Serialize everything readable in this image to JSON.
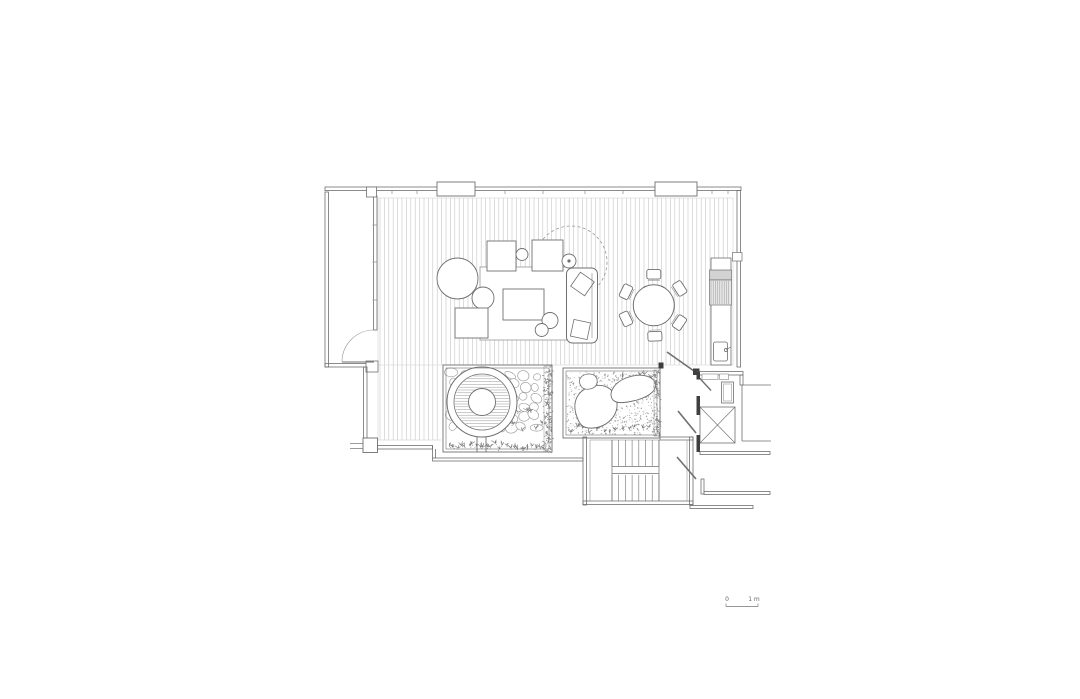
{
  "meta": {
    "background": "#ffffff"
  },
  "colors": {
    "ink": "#6f6f6f",
    "dark": "#3f3f3f",
    "mid": "#979797",
    "light": "#c6c6c6",
    "faint": "#d9d9d9",
    "green": "#7b7b7b",
    "fillGray": "#d2d2d2",
    "fillLight": "#e7e7e7",
    "white": "#ffffff",
    "text": "#666666"
  },
  "scale_bar": {
    "zero": "0",
    "one": "1 m"
  },
  "geometry": [
    {
      "k": "vlines",
      "n": "deck-boards-main",
      "x1": 380,
      "x2": 731,
      "step": 4.4,
      "y1": 198,
      "y2": 365,
      "s": "light",
      "sw": 0.6
    },
    {
      "k": "vlines",
      "n": "deck-boards-lower",
      "x1": 380,
      "x2": 440,
      "step": 4.4,
      "y1": 365,
      "y2": 440,
      "s": "light",
      "sw": 0.6
    },
    {
      "k": "rect",
      "n": "deck-edge",
      "x": 378,
      "y": 198,
      "w": 355,
      "h": 167,
      "s": "faint",
      "sw": 0.7
    },
    {
      "k": "line",
      "n": "deck-lower-edge-bottom",
      "x1": 378,
      "y1": 440,
      "x2": 441,
      "y2": 440,
      "s": "faint",
      "sw": 0.7
    },
    {
      "k": "line",
      "n": "deck-lower-edge-left",
      "x1": 378,
      "y1": 365,
      "x2": 378,
      "y2": 440,
      "s": "faint",
      "sw": 0.7
    },
    {
      "k": "pebbles",
      "n": "pebble-paving",
      "x": 448,
      "y": 370,
      "w": 94,
      "h": 66,
      "seed": 7
    },
    {
      "k": "plants",
      "n": "garden-ferns",
      "x": 505,
      "y": 398,
      "w": 38,
      "h": 38,
      "cnt": 8,
      "seed": 5
    },
    {
      "k": "circle",
      "n": "hot-tub-outer",
      "cx": 482,
      "cy": 402,
      "r": 35,
      "f": "white",
      "s": "ink",
      "sw": 1
    },
    {
      "k": "circle",
      "n": "hot-tub-rim",
      "cx": 482,
      "cy": 402,
      "r": 28,
      "s": "ink",
      "sw": 0.8
    },
    {
      "k": "hlines",
      "n": "hot-tub-water",
      "x1": 453,
      "x2": 511,
      "y1": 376,
      "y2": 429,
      "step": 2.8,
      "s": "mid",
      "sw": 0.5,
      "clip": [
        482,
        402,
        27.2
      ]
    },
    {
      "k": "circle",
      "n": "hot-tub-seat",
      "cx": 482,
      "cy": 402,
      "r": 13.5,
      "f": "white",
      "s": "ink",
      "sw": 0.9
    },
    {
      "k": "line",
      "n": "screen-post-1",
      "x1": 477,
      "y1": 437,
      "x2": 477,
      "y2": 452,
      "s": "ink",
      "sw": 0.9
    },
    {
      "k": "line",
      "n": "screen-post-2",
      "x1": 486,
      "y1": 437,
      "x2": 486,
      "y2": 452,
      "s": "ink",
      "sw": 0.9
    },
    {
      "k": "plants",
      "n": "planting-strip",
      "x": 447,
      "y": 441,
      "w": 98,
      "h": 10,
      "cnt": 26,
      "seed": 11
    },
    {
      "k": "hedge",
      "n": "hedge-strip-left-garden",
      "x": 544,
      "y": 366,
      "w": 8,
      "h": 86,
      "cnt": 170,
      "seed": 3
    },
    {
      "k": "rect",
      "n": "garden-left-wall-outer",
      "x": 443,
      "y": 365,
      "w": 109,
      "h": 87,
      "s": "ink",
      "sw": 0.9
    },
    {
      "k": "rect",
      "n": "garden-left-wall-inner",
      "x": 446,
      "y": 368,
      "w": 103,
      "h": 81,
      "s": "ink",
      "sw": 0.6
    },
    {
      "k": "stipple",
      "n": "gravel-bed",
      "x": 567,
      "y": 372,
      "w": 89,
      "h": 63,
      "cnt": 650,
      "seed": 21
    },
    {
      "k": "plants",
      "n": "garden-right-plants-bottom",
      "x": 567,
      "y": 424,
      "w": 85,
      "h": 11,
      "cnt": 13,
      "seed": 31
    },
    {
      "k": "plants",
      "n": "garden-right-plants-top",
      "x": 618,
      "y": 372,
      "w": 36,
      "h": 10,
      "cnt": 6,
      "seed": 41
    },
    {
      "k": "path",
      "n": "boulder-large",
      "d": "M 576,414 C 572,400 579,389 593,386 C 607,383 616,391 617,403 C 618,416 607,427 593,428 C 582,429 579,424 576,414 Z",
      "f": "white",
      "s": "ink",
      "sw": 0.9
    },
    {
      "k": "path",
      "n": "boulder-long",
      "d": "M 613,400 C 608,394 613,383 626,378 C 639,373 651,375 655,382 C 658,389 651,396 637,400 C 625,403 617,404 613,400 Z",
      "f": "white",
      "s": "ink",
      "sw": 0.9
    },
    {
      "k": "path",
      "n": "boulder-small",
      "d": "M 580,384 C 578,379 582,374 589,374 C 595,374 598,378 597,383 C 596,388 590,390 585,389 C 582,388 581,387 580,384 Z",
      "f": "white",
      "s": "ink",
      "sw": 0.8
    },
    {
      "k": "hedge",
      "n": "hedge-strip-right-garden",
      "x": 654,
      "y": 370,
      "w": 6,
      "h": 66,
      "cnt": 95,
      "seed": 13
    },
    {
      "k": "rect",
      "n": "garden-right-wall-outer",
      "x": 563,
      "y": 368,
      "w": 97,
      "h": 70,
      "s": "ink",
      "sw": 0.9
    },
    {
      "k": "rect",
      "n": "garden-right-wall-inner",
      "x": 566,
      "y": 371,
      "w": 91,
      "h": 64,
      "s": "ink",
      "sw": 0.6
    },
    {
      "k": "rect",
      "n": "wall-top",
      "x": 325,
      "y": 187,
      "w": 416,
      "h": 3.5,
      "s": "ink",
      "sw": 0.8
    },
    {
      "k": "vticks",
      "n": "window-mullion-ticks",
      "xs": [
        392,
        417,
        505,
        543,
        585,
        623,
        712,
        728
      ],
      "y": 190.5,
      "len": 3.5,
      "s": "mid",
      "sw": 0.8
    },
    {
      "k": "rect",
      "n": "mullion-box-1",
      "x": 437,
      "y": 182,
      "w": 38,
      "h": 14,
      "f": "white",
      "s": "ink",
      "sw": 0.9
    },
    {
      "k": "rect",
      "n": "mullion-box-2",
      "x": 655,
      "y": 182,
      "w": 42,
      "h": 14,
      "f": "white",
      "s": "ink",
      "sw": 0.9
    },
    {
      "k": "rect",
      "n": "balcony-wall-left",
      "x": 325,
      "y": 192,
      "w": 3.5,
      "h": 175,
      "s": "ink",
      "sw": 0.8
    },
    {
      "k": "rect",
      "n": "balcony-wall-bottom",
      "x": 325,
      "y": 363.5,
      "w": 52,
      "h": 3.5,
      "s": "ink",
      "sw": 0.8
    },
    {
      "k": "rect",
      "n": "balcony-wall-right",
      "x": 373.5,
      "y": 196,
      "w": 3.5,
      "h": 134,
      "s": "ink",
      "sw": 0.8
    },
    {
      "k": "hticks",
      "n": "balcony-mullion-ticks",
      "x": 372.5,
      "len": 4,
      "ys": [
        225,
        262,
        300
      ],
      "s": "mid",
      "sw": 0.8
    },
    {
      "k": "rect",
      "n": "balcony-post-top",
      "x": 366.5,
      "y": 187,
      "w": 10,
      "h": 10,
      "f": "white",
      "s": "ink",
      "sw": 0.8
    },
    {
      "k": "rect",
      "n": "balcony-post-bottom",
      "x": 366,
      "y": 361,
      "w": 12,
      "h": 11,
      "f": "white",
      "s": "ink",
      "sw": 0.8
    },
    {
      "k": "line",
      "n": "balcony-door-leaf",
      "x1": 342,
      "y1": 362,
      "x2": 374,
      "y2": 362,
      "s": "ink",
      "sw": 1
    },
    {
      "k": "path",
      "n": "balcony-door-swing",
      "d": "M 342,362 A 32 32 0 0 1 374,330",
      "s": "mid",
      "sw": 0.6
    },
    {
      "k": "rect",
      "n": "wall-right",
      "x": 737,
      "y": 190.5,
      "w": 3.5,
      "h": 176.5,
      "s": "ink",
      "sw": 0.8
    },
    {
      "k": "rect",
      "n": "wall-right-joint",
      "x": 732.5,
      "y": 252.5,
      "w": 9.5,
      "h": 8.5,
      "f": "white",
      "s": "ink",
      "sw": 0.7
    },
    {
      "k": "rect",
      "n": "wall-right-step",
      "x": 740,
      "y": 375,
      "w": 3,
      "h": 10,
      "s": "ink",
      "sw": 0.8
    },
    {
      "k": "rect",
      "n": "wall-left-lower",
      "x": 363.5,
      "y": 367,
      "w": 3.5,
      "h": 71,
      "s": "ink",
      "sw": 0.8
    },
    {
      "k": "rect",
      "n": "corner-block",
      "x": 363,
      "y": 438,
      "w": 14.5,
      "h": 14.5,
      "f": "white",
      "s": "ink",
      "sw": 0.9
    },
    {
      "k": "line",
      "n": "ledge-line-1",
      "x1": 350,
      "y1": 443.5,
      "x2": 363,
      "y2": 443.5,
      "s": "ink",
      "sw": 0.7
    },
    {
      "k": "line",
      "n": "ledge-line-2",
      "x1": 350,
      "y1": 448.5,
      "x2": 363,
      "y2": 448.5,
      "s": "ink",
      "sw": 0.7
    },
    {
      "k": "rect",
      "n": "wall-bottom-a",
      "x": 377.5,
      "y": 445.5,
      "w": 55,
      "h": 3.5,
      "s": "ink",
      "sw": 0.8
    },
    {
      "k": "path",
      "n": "wall-bottom-step",
      "d": "M 432.5,445.5 L 432.5,458 M 435.5,449 L 435.5,458",
      "s": "ink",
      "sw": 0.8
    },
    {
      "k": "rect",
      "n": "wall-bottom-b",
      "x": 432.5,
      "y": 458,
      "w": 150.5,
      "h": 3,
      "s": "ink",
      "sw": 0.8
    },
    {
      "k": "rect",
      "n": "stair-wall-left",
      "x": 583,
      "y": 437,
      "w": 3.5,
      "h": 68,
      "s": "ink",
      "sw": 0.8
    },
    {
      "k": "rect",
      "n": "stair-wall-bottom",
      "x": 583,
      "y": 501,
      "w": 110,
      "h": 3.5,
      "s": "ink",
      "sw": 0.8
    },
    {
      "k": "rect",
      "n": "stair-wall-right",
      "x": 689.5,
      "y": 437,
      "w": 3.5,
      "h": 68,
      "s": "ink",
      "sw": 0.8
    },
    {
      "k": "rect",
      "n": "stair-wall-top",
      "x": 660,
      "y": 437,
      "w": 33,
      "h": 3,
      "s": "ink",
      "sw": 0.8
    },
    {
      "k": "rect",
      "n": "stair-inner",
      "x": 590,
      "y": 440,
      "w": 97,
      "h": 61,
      "s": "mid",
      "sw": 0.6
    },
    {
      "k": "line",
      "n": "stair-stringer-left",
      "x1": 612,
      "y1": 440,
      "x2": 612,
      "y2": 501,
      "s": "ink",
      "sw": 0.7
    },
    {
      "k": "line",
      "n": "stair-stringer-right",
      "x1": 659,
      "y1": 440,
      "x2": 659,
      "y2": 501,
      "s": "ink",
      "sw": 0.7
    },
    {
      "k": "vlines",
      "n": "stair-treads-upper",
      "x1": 612,
      "x2": 659,
      "step": 6.7,
      "y1": 440,
      "y2": 466,
      "s": "ink",
      "sw": 0.6
    },
    {
      "k": "vlines",
      "n": "stair-treads-lower",
      "x1": 612,
      "x2": 659,
      "step": 6.7,
      "y1": 475,
      "y2": 501,
      "s": "ink",
      "sw": 0.6
    },
    {
      "k": "line",
      "n": "stair-landing-rail-1",
      "x1": 612,
      "y1": 466.5,
      "x2": 659,
      "y2": 466.5,
      "s": "ink",
      "sw": 0.7
    },
    {
      "k": "line",
      "n": "stair-landing-rail-2",
      "x1": 612,
      "y1": 473.5,
      "x2": 659,
      "y2": 473.5,
      "s": "ink",
      "sw": 0.7
    },
    {
      "k": "circle",
      "n": "tree-canopy-dashed",
      "cx": 571,
      "cy": 262,
      "r": 36,
      "s": "mid",
      "sw": 0.8,
      "dash": "3,2.5"
    },
    {
      "k": "rect",
      "n": "rug",
      "x": 480,
      "y": 267,
      "w": 90,
      "h": 73,
      "f": "white",
      "s": "mid",
      "sw": 0.8
    },
    {
      "k": "rect",
      "n": "lounge-chair-1",
      "x": 487,
      "y": 241,
      "w": 29,
      "h": 30,
      "f": "white",
      "s": "ink",
      "sw": 0.9
    },
    {
      "k": "rect",
      "n": "lounge-chair-2",
      "x": 532,
      "y": 240,
      "w": 31,
      "h": 31,
      "f": "white",
      "s": "ink",
      "sw": 0.9
    },
    {
      "k": "circle",
      "n": "pouf-small",
      "cx": 522,
      "cy": 254.5,
      "r": 6,
      "f": "white",
      "s": "ink",
      "sw": 0.9
    },
    {
      "k": "circle",
      "n": "side-table-round",
      "cx": 569,
      "cy": 261,
      "r": 7,
      "f": "white",
      "s": "ink",
      "sw": 0.9
    },
    {
      "k": "circle",
      "n": "side-table-dot",
      "cx": 569,
      "cy": 261,
      "r": 1.6,
      "f": "ink"
    },
    {
      "k": "circle",
      "n": "round-table-large",
      "cx": 457.5,
      "cy": 278.5,
      "r": 20.5,
      "f": "white",
      "s": "ink",
      "sw": 0.9
    },
    {
      "k": "circle",
      "n": "round-table-medium",
      "cx": 483,
      "cy": 298,
      "r": 11,
      "f": "white",
      "s": "ink",
      "sw": 0.9
    },
    {
      "k": "rect",
      "n": "floor-cushion",
      "x": 455,
      "y": 308,
      "w": 33,
      "h": 30,
      "f": "white",
      "s": "ink",
      "sw": 0.9
    },
    {
      "k": "rect",
      "n": "coffee-table",
      "x": 503,
      "y": 289,
      "w": 41,
      "h": 31,
      "f": "white",
      "s": "ink",
      "sw": 0.9
    },
    {
      "k": "circle",
      "n": "stool-1",
      "cx": 550,
      "cy": 320.5,
      "r": 8,
      "f": "white",
      "s": "ink",
      "sw": 0.9
    },
    {
      "k": "circle",
      "n": "stool-2",
      "cx": 541.7,
      "cy": 330,
      "r": 6.5,
      "f": "white",
      "s": "ink",
      "sw": 0.9
    },
    {
      "k": "rect",
      "n": "sofa",
      "x": 566.5,
      "y": 268,
      "w": 31,
      "h": 75,
      "rx": 6,
      "f": "white",
      "s": "ink",
      "sw": 1
    },
    {
      "k": "line",
      "n": "sofa-back-line",
      "x1": 592,
      "y1": 273,
      "x2": 592,
      "y2": 338,
      "s": "mid",
      "sw": 0.7
    },
    {
      "k": "rect",
      "n": "sofa-cushion-1",
      "x": 574,
      "y": 275.5,
      "w": 17,
      "h": 17,
      "rot": 35,
      "s": "ink",
      "sw": 0.8
    },
    {
      "k": "rect",
      "n": "sofa-cushion-2",
      "x": 572,
      "y": 321,
      "w": 17,
      "h": 17,
      "rot": 12,
      "s": "ink",
      "sw": 0.8
    },
    {
      "k": "circle",
      "n": "dining-table",
      "cx": 653.8,
      "cy": 305.3,
      "r": 20.5,
      "f": "white",
      "s": "ink",
      "sw": 1
    },
    {
      "k": "chairs",
      "n": "dining-chairs",
      "cx": 653.8,
      "cy": 305.3,
      "angles": [
        0,
        57,
        124,
        178,
        244,
        296
      ],
      "dist": 31,
      "w": 14,
      "h": 9.5
    },
    {
      "k": "rect",
      "n": "kitchen-counter",
      "x": 711,
      "y": 258,
      "w": 20,
      "h": 107,
      "f": "white",
      "s": "ink",
      "sw": 0.8
    },
    {
      "k": "rect",
      "n": "grill-hood",
      "x": 709.5,
      "y": 270,
      "w": 22,
      "h": 10,
      "f": "fillGray",
      "s": "ink",
      "sw": 0.7
    },
    {
      "k": "rect",
      "n": "grill-body",
      "x": 709.5,
      "y": 280,
      "w": 22,
      "h": 25,
      "f": "fillLight",
      "s": "ink",
      "sw": 0.7
    },
    {
      "k": "vlines",
      "n": "grill-hatch",
      "x1": 711,
      "x2": 730.5,
      "step": 2.2,
      "y1": 281,
      "y2": 304,
      "s": "mid",
      "sw": 0.5
    },
    {
      "k": "rect",
      "n": "sink",
      "x": 713.5,
      "y": 342,
      "w": 14,
      "h": 19,
      "rx": 2,
      "f": "white",
      "s": "ink",
      "sw": 0.8
    },
    {
      "k": "circle",
      "n": "faucet",
      "cx": 726,
      "cy": 350,
      "r": 1.6,
      "f": "white",
      "s": "ink",
      "sw": 0.8
    },
    {
      "k": "line",
      "n": "faucet-spout",
      "x1": 726,
      "y1": 350,
      "x2": 730.5,
      "y2": 347,
      "s": "ink",
      "sw": 0.7
    },
    {
      "k": "rect",
      "n": "glazing-end-tick",
      "x": 658.5,
      "y": 362.5,
      "w": 5,
      "h": 6,
      "f": "dark"
    },
    {
      "k": "line",
      "n": "entry-door-leaf",
      "x1": 667,
      "y1": 352,
      "x2": 694,
      "y2": 371,
      "s": "ink",
      "sw": 1.6
    },
    {
      "k": "rect",
      "n": "entry-jamb",
      "x": 693,
      "y": 368.5,
      "w": 6.5,
      "h": 6.5,
      "f": "dark"
    },
    {
      "k": "rect",
      "n": "vestibule-top-wall",
      "x": 697,
      "y": 371.5,
      "w": 46,
      "h": 3.5,
      "s": "ink",
      "sw": 0.8
    },
    {
      "k": "rect",
      "n": "vestibule-frame-1",
      "x": 702,
      "y": 374,
      "w": 16,
      "h": 5.5,
      "f": "white",
      "s": "mid",
      "sw": 0.7
    },
    {
      "k": "rect",
      "n": "vestibule-frame-2",
      "x": 719.5,
      "y": 374,
      "w": 9,
      "h": 5.5,
      "f": "white",
      "s": "mid",
      "sw": 0.7
    },
    {
      "k": "rect",
      "n": "bench",
      "x": 721.5,
      "y": 382,
      "w": 12,
      "h": 21,
      "s": "ink",
      "sw": 0.8
    },
    {
      "k": "rect",
      "n": "bench-inner",
      "x": 723.5,
      "y": 384,
      "w": 8,
      "h": 17,
      "s": "mid",
      "sw": 0.6
    },
    {
      "k": "line",
      "n": "vestibule-door-leaf",
      "x1": 699,
      "y1": 377.5,
      "x2": 711,
      "y2": 390.5,
      "s": "ink",
      "sw": 1.4
    },
    {
      "k": "rect",
      "n": "door-jamb-1",
      "x": 696.5,
      "y": 371.5,
      "w": 3.5,
      "h": 8,
      "f": "dark"
    },
    {
      "k": "rect",
      "n": "door-jamb-2",
      "x": 696.5,
      "y": 396,
      "w": 3.5,
      "h": 11,
      "f": "dark"
    },
    {
      "k": "xbox",
      "n": "elevator",
      "x": 700,
      "y": 407,
      "w": 35,
      "h": 36,
      "s": "ink",
      "sw": 0.8
    },
    {
      "k": "rect",
      "n": "door-jamb-3",
      "x": 696.5,
      "y": 407,
      "w": 3.5,
      "h": 8,
      "f": "dark"
    },
    {
      "k": "rect",
      "n": "door-jamb-4",
      "x": 696.5,
      "y": 435,
      "w": 3.5,
      "h": 8,
      "f": "dark"
    },
    {
      "k": "line",
      "n": "lobby-door-leaf-1",
      "x1": 678,
      "y1": 411,
      "x2": 696,
      "y2": 433,
      "s": "ink",
      "sw": 1.6
    },
    {
      "k": "line",
      "n": "lobby-door-leaf-2",
      "x1": 677,
      "y1": 457,
      "x2": 696,
      "y2": 479,
      "s": "ink",
      "sw": 1.6
    },
    {
      "k": "rect",
      "n": "door-jamb-5",
      "x": 696.5,
      "y": 443,
      "w": 3.5,
      "h": 9,
      "f": "dark"
    },
    {
      "k": "line",
      "n": "corridor-room-top",
      "x1": 742,
      "y1": 385,
      "x2": 771,
      "y2": 385,
      "s": "ink",
      "sw": 0.8
    },
    {
      "k": "line",
      "n": "corridor-room-left",
      "x1": 742,
      "y1": 385,
      "x2": 742,
      "y2": 441,
      "s": "ink",
      "sw": 0.8
    },
    {
      "k": "line",
      "n": "corridor-room-bottom",
      "x1": 742,
      "y1": 441,
      "x2": 771,
      "y2": 441,
      "s": "ink",
      "sw": 0.8
    },
    {
      "k": "rect",
      "n": "corridor-wall-a",
      "x": 700,
      "y": 451.5,
      "w": 70,
      "h": 3,
      "s": "ink",
      "sw": 0.8
    },
    {
      "k": "rect",
      "n": "corridor-wall-b",
      "x": 701,
      "y": 479,
      "w": 3,
      "h": 15,
      "s": "ink",
      "sw": 0.8
    },
    {
      "k": "rect",
      "n": "corridor-wall-c",
      "x": 704,
      "y": 491.5,
      "w": 66,
      "h": 3,
      "s": "ink",
      "sw": 0.8
    },
    {
      "k": "rect",
      "n": "corridor-wall-d",
      "x": 690,
      "y": 505.5,
      "w": 63,
      "h": 3,
      "s": "ink",
      "sw": 0.8
    },
    {
      "k": "text",
      "n": "scale-label-zero",
      "x": 727,
      "y": 601,
      "fs": 6,
      "bind": "scale_bar.zero",
      "anchor": "middle"
    },
    {
      "k": "text",
      "n": "scale-label-one",
      "x": 754,
      "y": 601,
      "fs": 6,
      "bind": "scale_bar.one",
      "anchor": "middle"
    },
    {
      "k": "line",
      "n": "scale-bar-line",
      "x1": 726,
      "y1": 606.5,
      "x2": 758,
      "y2": 606.5,
      "s": "mid",
      "sw": 0.9
    },
    {
      "k": "line",
      "n": "scale-bar-tick-left",
      "x1": 726,
      "y1": 603.5,
      "x2": 726,
      "y2": 606.5,
      "s": "mid",
      "sw": 0.9
    },
    {
      "k": "line",
      "n": "scale-bar-tick-right",
      "x1": 758,
      "y1": 603.5,
      "x2": 758,
      "y2": 606.5,
      "s": "mid",
      "sw": 0.9
    }
  ]
}
